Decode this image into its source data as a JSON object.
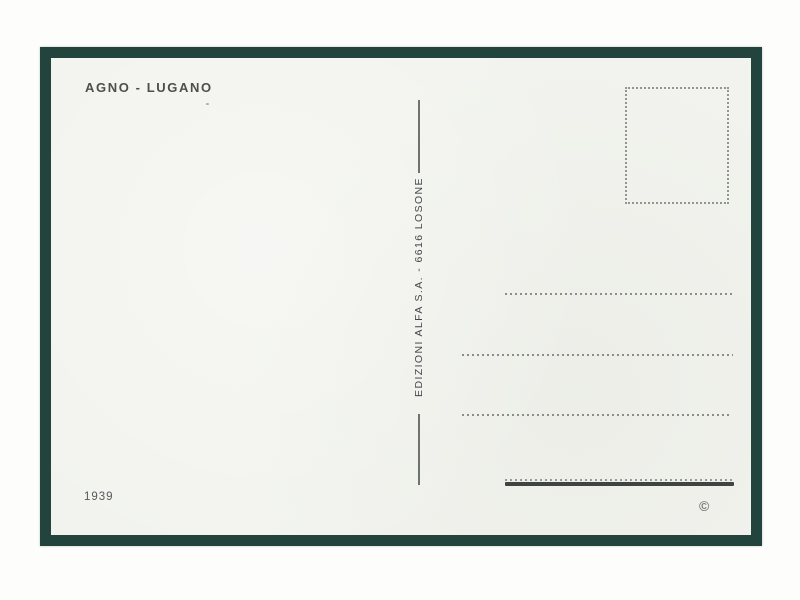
{
  "postcard": {
    "title": "AGNO - LUGANO",
    "publisher_line": "EDIZIONI ALFA S.A. - 6616 LOSONE",
    "catalog_number": "1939",
    "copyright_symbol": "©"
  },
  "colors": {
    "frame_green": "#22443c",
    "card_background": "#f2f3ee",
    "title_ink": "#4e4f4d",
    "publisher_ink": "#45464a",
    "dotted_line": "#8d8d88",
    "signature_bar": "#3e4442",
    "stamp_box_dots": "#95958f"
  }
}
